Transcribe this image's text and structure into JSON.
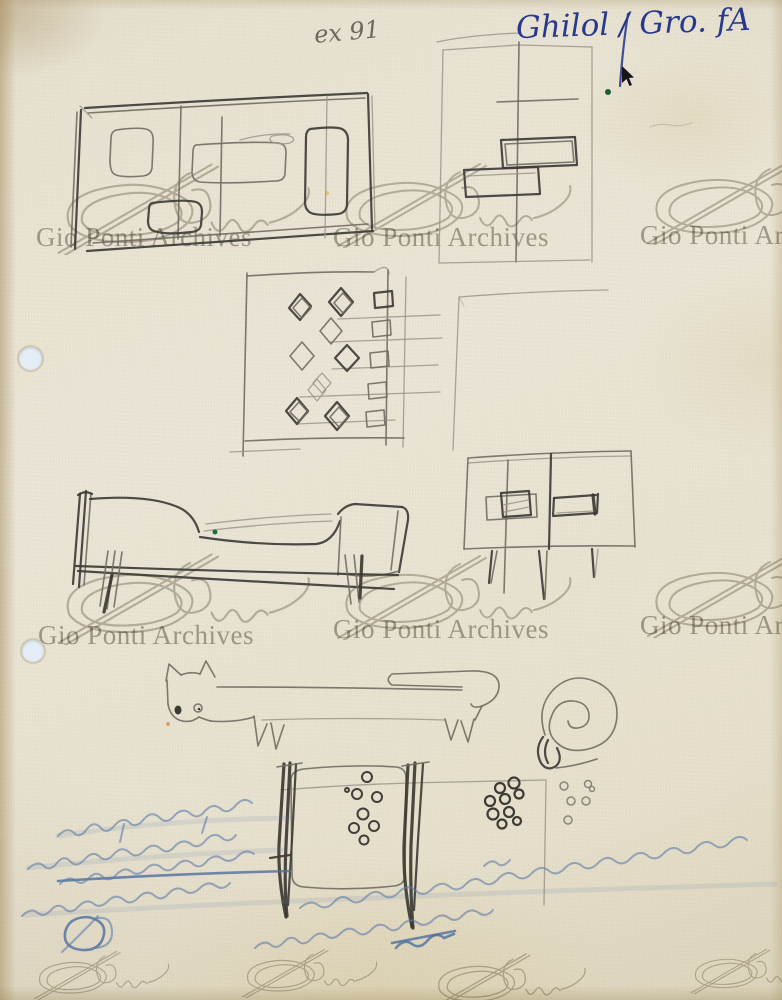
{
  "paper": {
    "base_color": "#e9e3d2",
    "edge_tint": "#c7b488"
  },
  "palette": {
    "pencil_dark": "#3e3c37",
    "pencil_medium": "#6f6b62",
    "pencil_light": "#9a958a",
    "blue_ink": "#2a3a8c",
    "verso_blue": "#5d7ca8",
    "watermark_gray": "#a19d92",
    "green_speck": "#1d6b3d",
    "hole_fill": "#e4edf5"
  },
  "annotations": {
    "pencil_note": "ex 91",
    "ink_note": "Ghilol / Gro. fA"
  },
  "watermark": {
    "text": "Gio Ponti Archives"
  },
  "marks": {
    "hole_punches": 2,
    "green_specks": 2,
    "cursor_arrow": 1
  },
  "figures": {
    "labels": [
      "cabinet-front-elevation",
      "shelf-composition-study",
      "diamond-pattern-panel",
      "faint-rectangle-outline",
      "sofa-daybed-profile",
      "sideboard-with-two-doors",
      "cat-figure",
      "snail-spiral",
      "drum-with-dot-pattern",
      "dot-cluster-dark",
      "dot-cluster-light",
      "mirrored-verso-handwriting"
    ]
  }
}
